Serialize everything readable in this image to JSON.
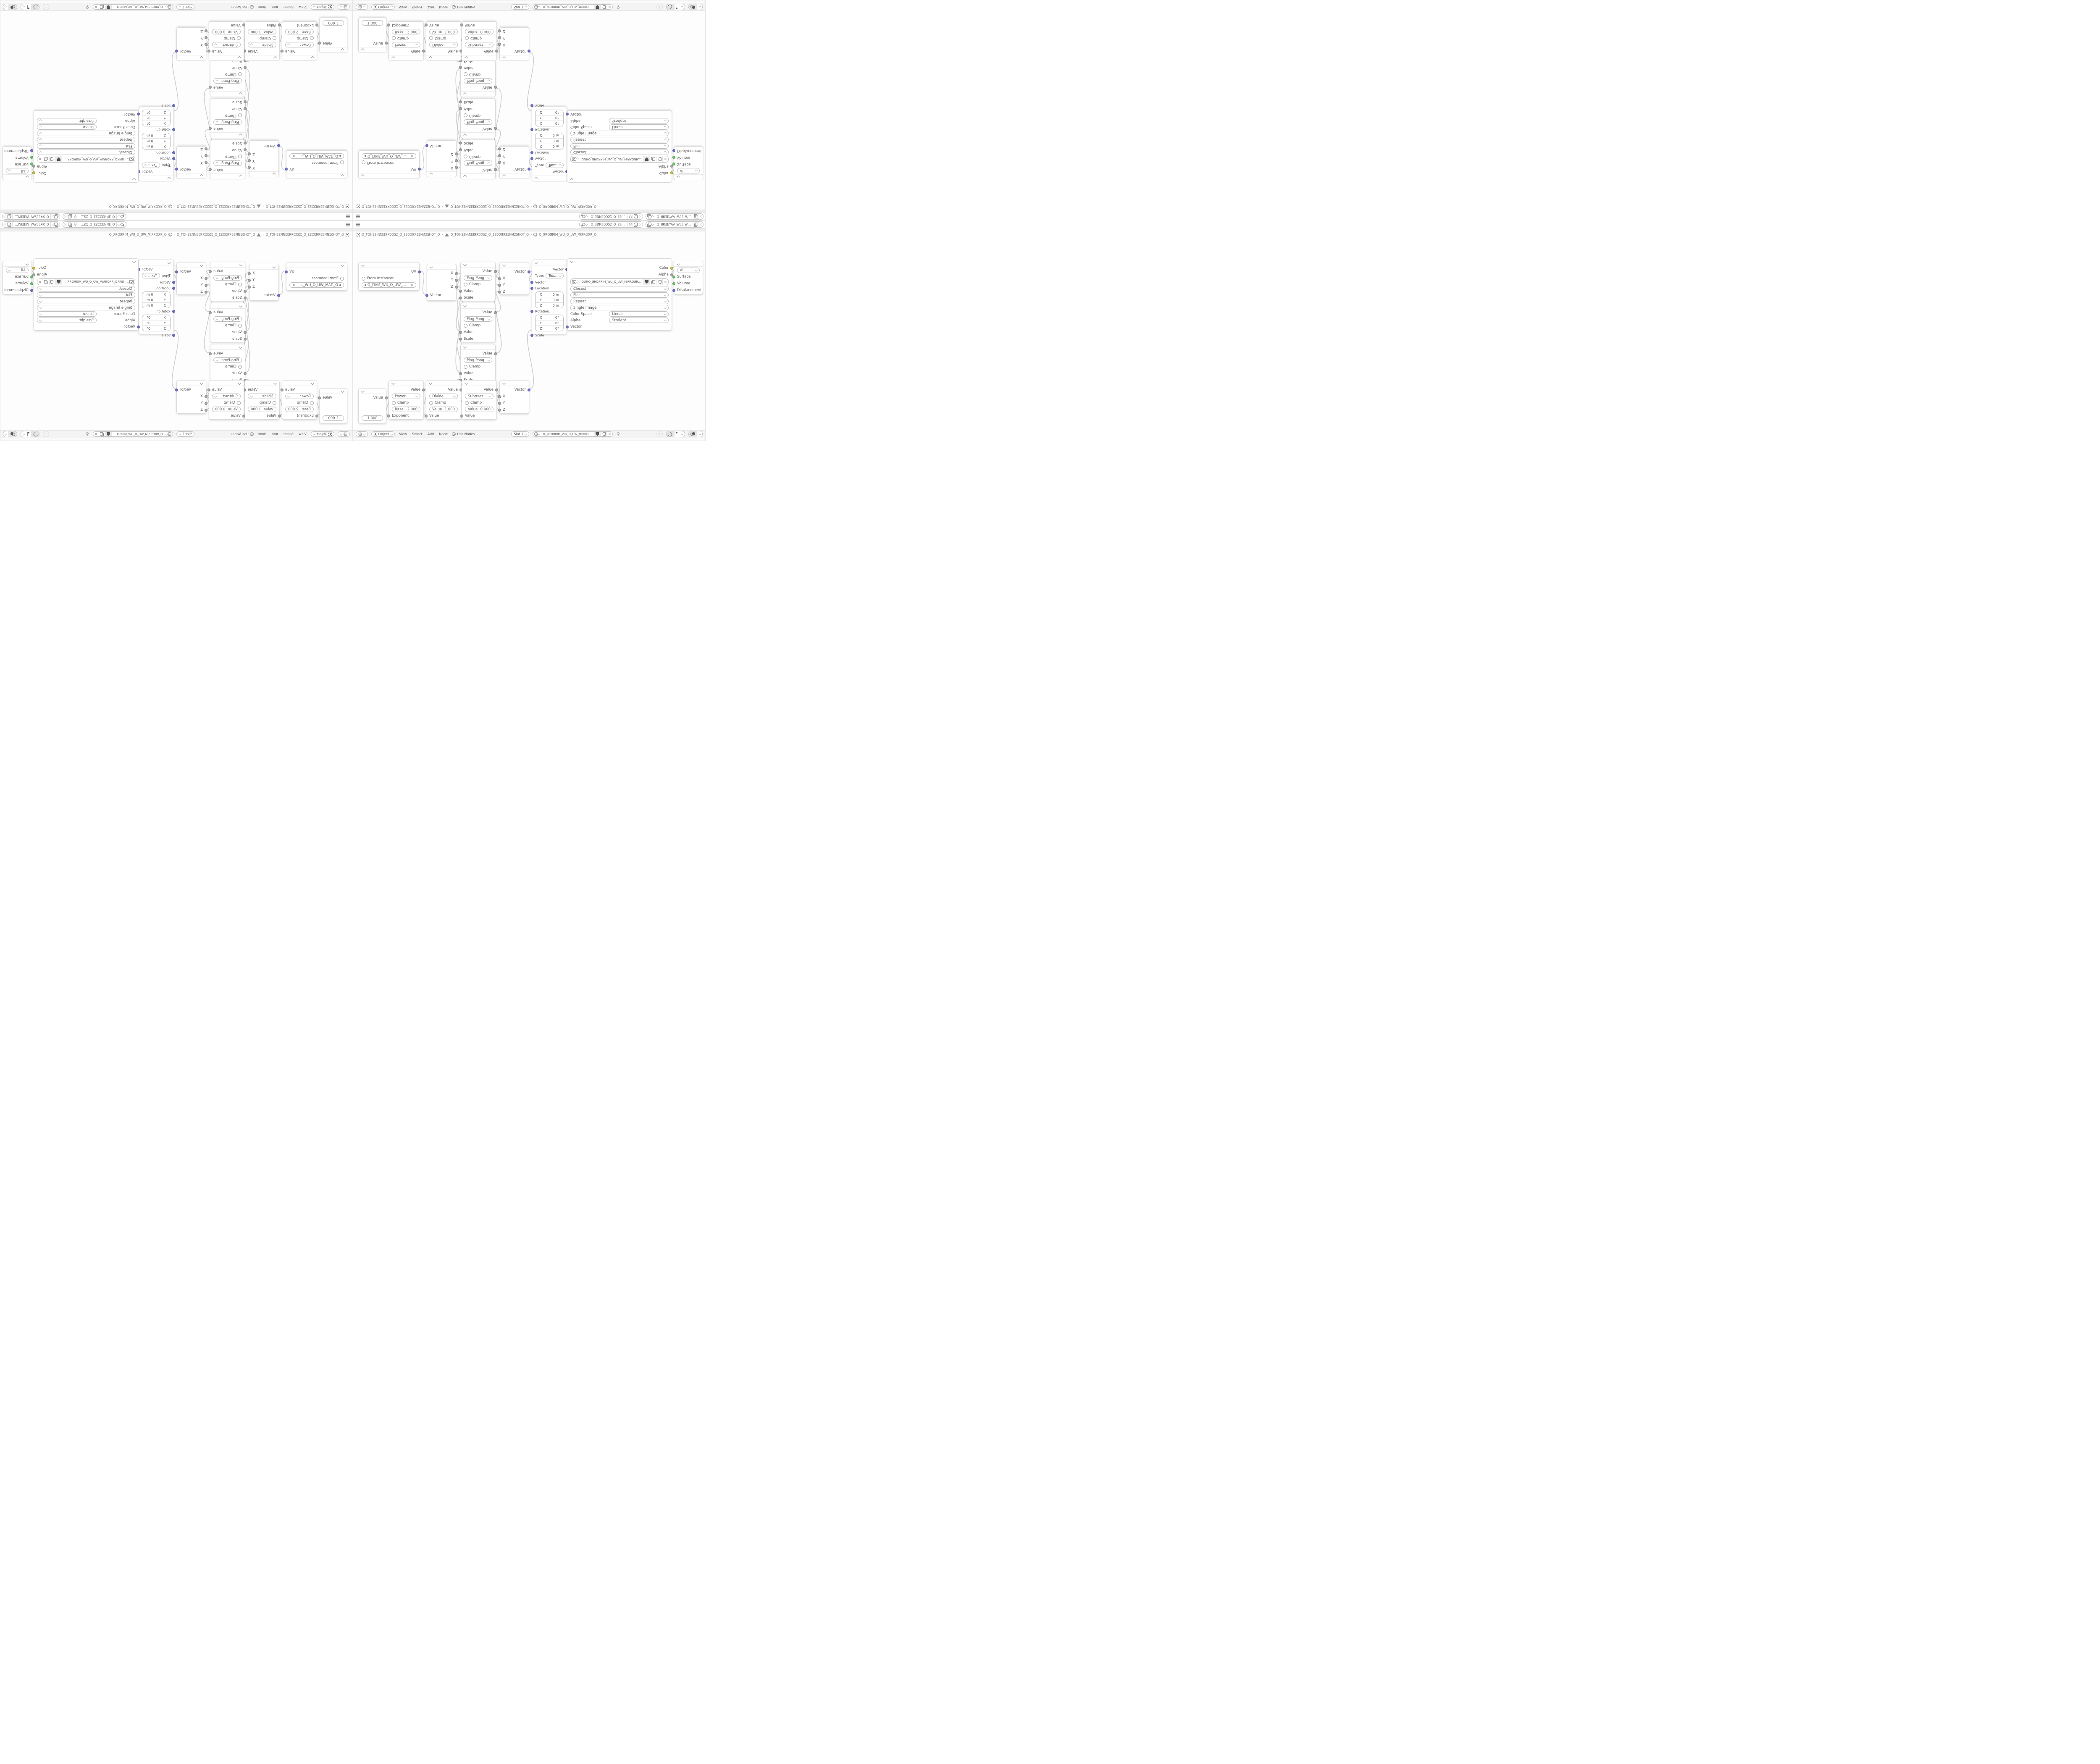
{
  "topbar": {
    "scene_field": "O_ƎͶͶƎƆƆS2_O_2SƆƆƎͶͶƎ_O",
    "view_layer_field": "O_ЯRƎEYAV_WƎEIW_O_WIƎEW_VAYƎER_O"
  },
  "path_bar": {
    "object_name": "O_TOHS2ͶͶƎƎЯЯƆƆS2_O_2SƆƆЯЯƎƎͶͶ2SHOT_O",
    "mesh_name": "O_TOHS2ͶͶƎƎЯЯƆƆS2_O_2SƆƆЯЯƎƎͶͶ2SHOT_O",
    "material_name": "O_ЯROЯRIM_WU_O_UW_MIЯROЯR_O",
    "separator": "›"
  },
  "nodes": {
    "uv_map": {
      "output": "UV",
      "from_instancer": "From Instancer",
      "uv_map_name": "O_ПAM_WU_O_UW_MAП_O"
    },
    "separate_xyz": {
      "outputs": [
        "X",
        "Y",
        "Z"
      ],
      "input": "Vector"
    },
    "math_ping_pong": {
      "output": "Value",
      "operation": "Ping-Pong",
      "clamp": "Clamp",
      "input_value": "Value",
      "input_scale": "Scale"
    },
    "combine_xyz": {
      "output": "Vector",
      "inputs": [
        "X",
        "Y",
        "Z"
      ]
    },
    "mapping": {
      "output": "Vector",
      "type_label": "Type:",
      "type_value": "Texture",
      "input_vector": "Vector",
      "location_label": "Location:",
      "rotation_label": "Rotation:",
      "scale_label": "Scale",
      "location_rows": [
        {
          "axis": "X",
          "value": "0 m"
        },
        {
          "axis": "Y",
          "value": "0 m"
        },
        {
          "axis": "Z",
          "value": "0 m"
        }
      ],
      "rotation_rows": [
        {
          "axis": "X",
          "value": "0°"
        },
        {
          "axis": "Y",
          "value": "0°"
        },
        {
          "axis": "Z",
          "value": "0°"
        }
      ]
    },
    "image_texture": {
      "output_color": "Color",
      "output_alpha": "Alpha",
      "filename": "GИP.O_ЯROЯRIM_WU_O_UW_MIЯROЯR_O.PNG",
      "interpolation": "Closest",
      "projection": "Flat",
      "extension": "Repeat",
      "source": "Single Image",
      "color_space_label": "Color Space",
      "color_space_value": "Linear",
      "alpha_label": "Alpha",
      "alpha_value": "Straight",
      "input_vector": "Vector"
    },
    "material_output": {
      "target": "All",
      "input_surface": "Surface",
      "input_volume": "Volume",
      "input_displacement": "Displacement"
    },
    "value": {
      "output": "Value",
      "value": "1.000"
    },
    "math_power": {
      "output": "Value",
      "operation": "Power",
      "clamp": "Clamp",
      "field_label": "Base",
      "field_value": "2.000",
      "input": "Exponent"
    },
    "math_divide": {
      "output": "Value",
      "operation": "Divide",
      "clamp": "Clamp",
      "field_label": "Value",
      "field_value": "1.000",
      "input": "Value"
    },
    "math_subtract": {
      "output": "Value",
      "operation": "Subtract",
      "clamp": "Clamp",
      "field_label": "Value",
      "field_value": "0.000",
      "input": "Value"
    }
  },
  "header": {
    "mode": "Object",
    "menus": [
      "View",
      "Select",
      "Add",
      "Node"
    ],
    "use_nodes": "Use Nodes",
    "slot": "Slot 1",
    "material_name": "O_ЯROЯRIM_WU_O_UW_MIЯROЯR_O"
  },
  "colors": {
    "socket_vector": "#6b6fd0",
    "socket_value": "#a6a6a6",
    "socket_color": "#c8bf2e",
    "socket_shader": "#62c462",
    "wire": "#c7c7c7",
    "node_bg": "#ffffff",
    "canvas_bg": "#fdfdfd",
    "bar_bg": "#f4f4f4"
  }
}
